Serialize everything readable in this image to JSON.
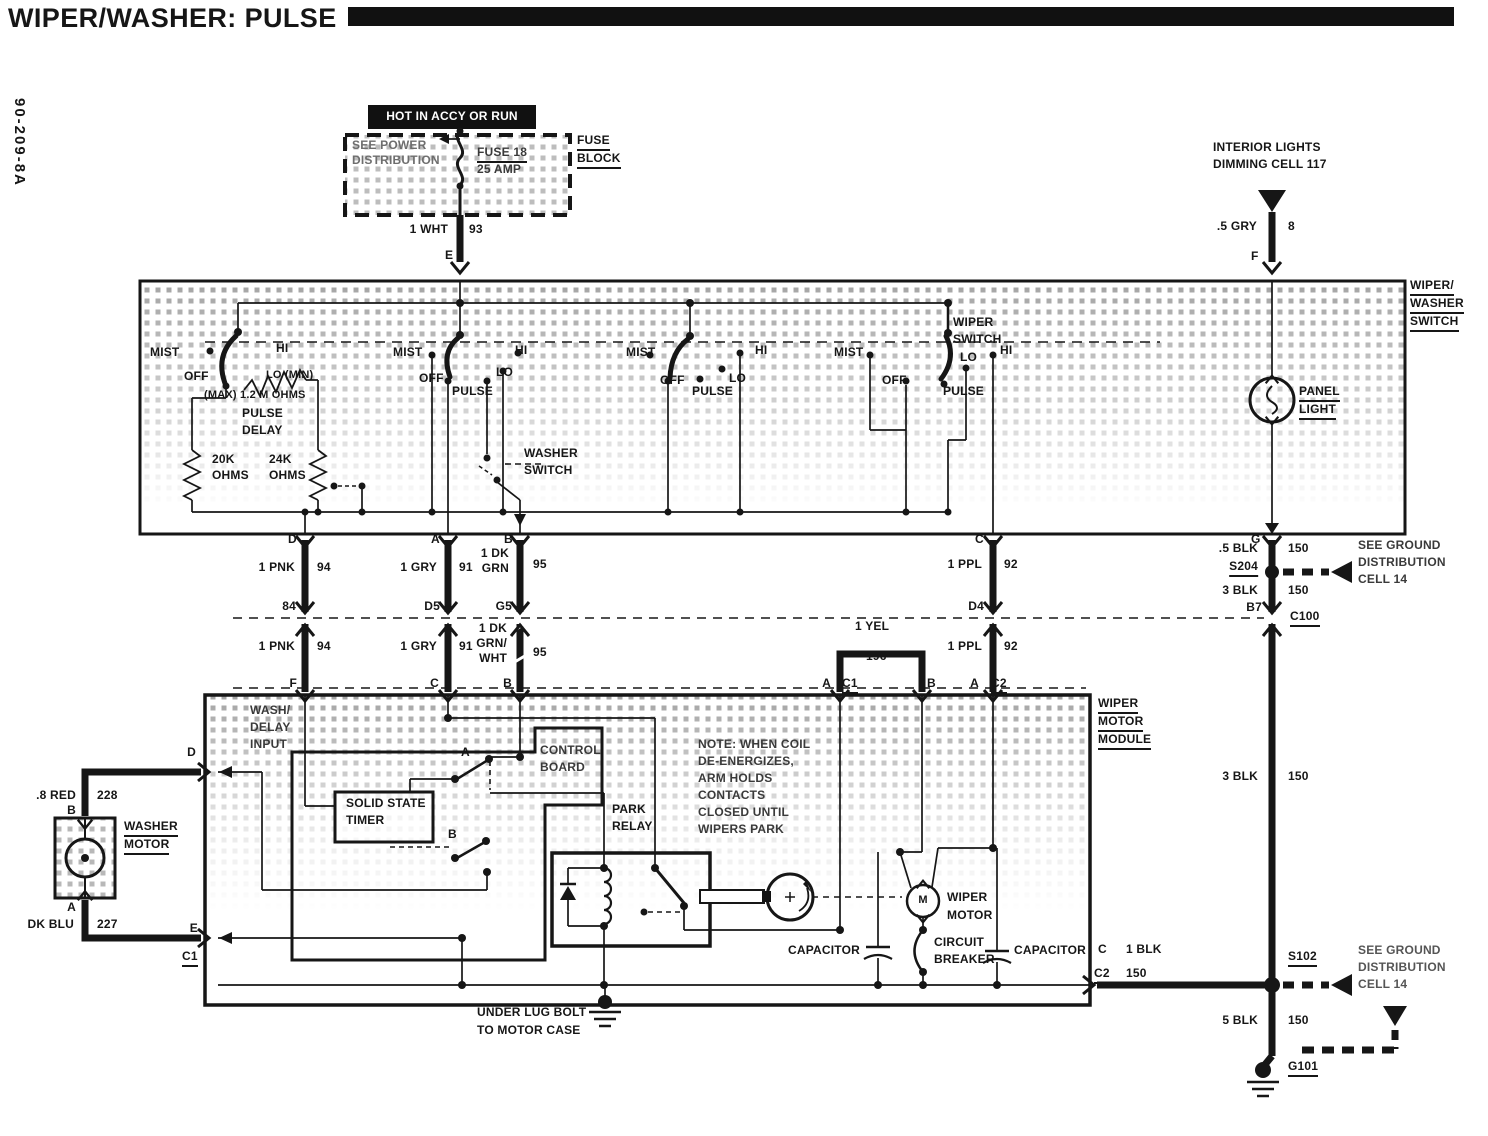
{
  "header": {
    "title": "WIPER/WASHER: PULSE",
    "doc_code": "90-209-8A"
  },
  "fuse": {
    "hot": "HOT IN ACCY OR RUN",
    "see1": "SEE POWER",
    "see2": "DISTRIBUTION",
    "name": "FUSE 18",
    "amp": "25 AMP",
    "blk1": "FUSE",
    "blk2": "BLOCK",
    "wire": "1 WHT",
    "ckt": "93",
    "pin": "E"
  },
  "interior": {
    "l1": "INTERIOR LIGHTS",
    "l2": "DIMMING CELL 117",
    "wire": ".5 GRY",
    "ckt": "8",
    "pin": "F"
  },
  "sw": {
    "t1": "WIPER/",
    "t2": "WASHER",
    "t3": "SWITCH",
    "panel1": "PANEL",
    "panel2": "LIGHT",
    "c1": {
      "mist": "MIST",
      "off": "OFF",
      "hi": "HI",
      "lo": "LO (MIN)",
      "max": "(MAX) 1.2 M OHMS",
      "pulse": "PULSE",
      "delay": "DELAY",
      "r1": "20K",
      "r1u": "OHMS",
      "r2": "24K",
      "r2u": "OHMS"
    },
    "c2": {
      "mist": "MIST",
      "off": "OFF",
      "pulse": "PULSE",
      "lo": "LO",
      "hi": "HI"
    },
    "wash1": "WASHER",
    "wash2": "SWITCH",
    "c3": {
      "mist": "MIST",
      "off": "OFF",
      "pulse": "PULSE",
      "lo": "LO",
      "hi": "HI"
    },
    "c4": {
      "mist": "MIST",
      "off": "OFF",
      "pulse": "PULSE",
      "lo": "LO",
      "hi": "HI",
      "t1": "WIPER",
      "t2": "SWITCH"
    },
    "pins": {
      "d": "D",
      "a": "A",
      "b": "B",
      "c": "C",
      "g": "G"
    }
  },
  "wires": {
    "pnk1": "1 PNK",
    "pnk1c": "94",
    "p84": "84",
    "pnk2": "1 PNK",
    "pnk2c": "94",
    "pf": "F",
    "gry1": "1 GRY",
    "gry1c": "91",
    "pd5": "D5",
    "gry2": "1 GRY",
    "gry2c": "91",
    "pc": "C",
    "grn1a": "1 DK",
    "grn1b": "GRN",
    "grn1c": "95",
    "pg5": "G5",
    "grn2a": "1 DK",
    "grn2b": "GRN/",
    "grn2c": "WHT",
    "grn2k": "95",
    "pb": "B",
    "ppl1": "1 PPL",
    "ppl1c": "92",
    "pd4": "D4",
    "ppl2": "1 PPL",
    "ppl2c": "92",
    "pa": "A",
    "c2": "C2",
    "yel": "1 YEL",
    "yelc": "196",
    "ya": "A",
    "yc1": "C1",
    "yb": "B"
  },
  "right": {
    "blk5": ".5 BLK",
    "blk5c": "150",
    "s204": "S204",
    "blk3": "3 BLK",
    "blk3c": "150",
    "b7": "B7",
    "c100": "C100",
    "see1": "SEE GROUND",
    "see2": "DISTRIBUTION",
    "see3": "CELL 14",
    "blk3b": "3 BLK",
    "blk3bc": "150",
    "pc": "C",
    "blk1": "1 BLK",
    "c2": "C2",
    "blk1c": "150",
    "s102": "S102",
    "see4": "SEE GROUND",
    "see5": "DISTRIBUTION",
    "see6": "CELL 14",
    "blk5b": "5 BLK",
    "blk5bc": "150",
    "g101": "G101"
  },
  "washer": {
    "l1": "WASHER",
    "l2": "MOTOR",
    "red": ".8 RED",
    "redc": "228",
    "pb": "B",
    "pa": "A",
    "blu": "DK BLU",
    "bluc": "227",
    "pd": "D",
    "pe": "E",
    "c1": "C1"
  },
  "module": {
    "t1": "WIPER",
    "t2": "MOTOR",
    "t3": "MODULE",
    "in1": "WASH/",
    "in2": "DELAY",
    "in3": "INPUT",
    "timer1": "SOLID STATE",
    "timer2": "TIMER",
    "board1": "CONTROL",
    "board2": "BOARD",
    "swa": "A",
    "swb": "B",
    "relay1": "PARK",
    "relay2": "RELAY",
    "note": [
      "NOTE: WHEN COIL",
      "DE-ENERGIZES,",
      "ARM HOLDS",
      "CONTACTS",
      "CLOSED UNTIL",
      "WIPERS PARK"
    ],
    "motor1": "WIPER",
    "motor2": "MOTOR",
    "m": "M",
    "cb1": "CIRCUIT",
    "cb2": "BREAKER",
    "cap1": "CAPACITOR",
    "cap2": "CAPACITOR",
    "gnd1": "UNDER LUG BOLT",
    "gnd2": "TO MOTOR CASE"
  }
}
